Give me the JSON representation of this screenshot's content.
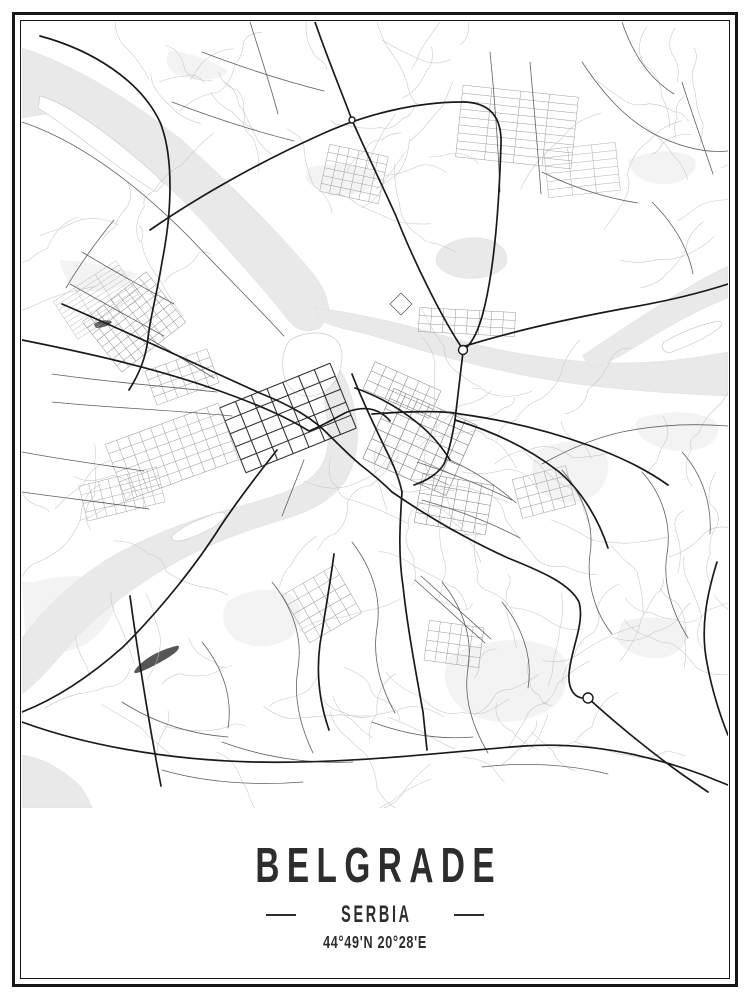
{
  "poster": {
    "title": "BELGRADE",
    "subtitle": "SERBIA",
    "coordinates": "44°49'N 20°28'E",
    "colors": {
      "text": "#2d2d2d",
      "frame": "#161616"
    }
  },
  "map": {
    "colors": {
      "water": "#e9e9e9",
      "water_edge": "#dedede",
      "park": "#f3f3f3",
      "island_edge": "#cccccc",
      "dark_shape": "#565656",
      "minor": "#c6c6c6",
      "medium": "#5f5f5f",
      "major": "#1a1a1a"
    },
    "parks": [
      "M38,238 C70,240 100,246 116,252 C104,266 84,272 60,268 C48,264 40,252 38,238 Z",
      "M205,580 C222,568 248,564 268,572 C280,580 282,596 272,612 C258,626 232,628 214,618 C200,608 198,592 205,580 Z",
      "M516,428 C536,418 562,416 580,428 C590,438 588,456 576,470 C560,484 534,484 520,470 C508,456 508,440 516,428 Z",
      "M428,634 C458,618 500,612 532,626 C548,636 550,660 536,680 C514,702 470,706 444,690 C422,674 418,650 428,634 Z",
      "M618,396 C644,388 672,388 692,398 C700,406 696,420 680,426 C658,432 634,428 620,416 C612,408 612,400 618,396 Z",
      "M286,146 C310,140 336,140 352,150 C358,158 350,168 332,172 C310,174 292,168 284,158 Z",
      "M148,28 C172,32 196,40 206,50 C196,60 172,60 154,52 C144,46 142,36 148,28 Z",
      "M12,560 C40,552 70,552 92,562 C100,580 88,606 64,622 C40,634 16,634 4,624 L0,560 Z",
      "M600,600 C624,592 650,594 664,606 C670,618 660,632 640,636 C618,638 600,628 594,616 Z",
      "M606,138 C628,128 654,126 672,136 C678,146 668,158 648,162 C626,164 608,154 606,138 Z"
    ],
    "water": [
      "M0,26 C50,42 105,75 160,118 C215,168 258,212 288,248 C301,263 307,277 307,292 L298,306 C284,312 274,308 266,298 C248,274 222,246 192,212 C156,172 112,130 66,100 C44,88 20,92 0,96 Z",
      "M292,286 C330,290 375,300 430,316 C490,333 545,340 595,341 C640,341 675,336 706,330 L706,374 C660,372 610,369 555,362 C495,354 440,340 395,327 C365,318 340,310 322,307 L300,300 Z",
      "M296,346 C302,372 306,398 306,422 C304,440 296,452 280,462 C258,474 232,480 205,488 C168,498 132,512 98,530 C62,550 32,576 8,606 L0,616 L0,672 C14,662 30,644 52,618 C80,588 118,560 158,538 C196,518 232,506 266,496 C292,488 312,476 324,458 C334,440 338,420 334,396 C330,372 324,356 318,348 Z",
      "M560,334 C596,310 634,284 672,262 C686,254 697,248 706,244 L706,276 C680,286 650,302 618,322 C596,336 580,344 570,346 Z",
      "M414,238 C414,224 436,214 458,216 C478,218 488,230 484,242 C478,254 452,260 432,254 C420,250 414,244 414,238 Z",
      "M0,733 C22,736 44,750 58,764 C64,772 68,780 70,786 L0,786 Z"
    ],
    "islands": [
      "M18,74 C40,80 70,100 102,126 C122,142 136,154 142,162 L134,170 C120,162 98,146 74,128 C52,111 32,96 16,86 Z",
      "M268,318 C282,310 300,308 312,316 C320,322 322,334 318,348 C314,362 304,372 290,374 C276,375 266,368 262,354 C259,340 261,326 268,318 Z",
      "M150,514 C158,506 174,498 192,492 C200,489 205,490 203,495 C198,503 182,511 166,517 C156,520 148,520 150,514 Z",
      "M642,320 C656,312 674,304 692,300 C700,298 702,302 696,307 C684,316 666,324 650,330 C642,332 638,326 642,320 Z"
    ],
    "dark_shapes": [
      "M113,648 C122,636 138,628 154,624 C158,623 158,626 154,630 C144,638 128,646 118,650 C113,652 111,651 113,648 Z",
      "M72,302 C78,298 86,297 90,300 C87,304 80,306 74,306 Z"
    ],
    "grids": [
      {
        "cx": 266,
        "cy": 396,
        "rows": 5,
        "cols": 7,
        "cw": 17,
        "ch": 14,
        "angle": -22,
        "stroke": "#2e2e2e",
        "width": 1.05
      },
      {
        "cx": 150,
        "cy": 430,
        "rows": 6,
        "cols": 10,
        "cw": 12,
        "ch": 10,
        "angle": -20,
        "stroke": "#9a9a9a",
        "width": 0.5
      },
      {
        "cx": 100,
        "cy": 472,
        "rows": 4,
        "cols": 8,
        "cw": 10,
        "ch": 9,
        "angle": -14,
        "stroke": "#a8a8a8",
        "width": 0.5
      },
      {
        "cx": 112,
        "cy": 300,
        "rows": 8,
        "cols": 9,
        "cw": 9,
        "ch": 8,
        "angle": -38,
        "stroke": "#8d8d8d",
        "width": 0.5
      },
      {
        "cx": 75,
        "cy": 278,
        "rows": 9,
        "cols": 3,
        "cw": 25,
        "ch": 5,
        "angle": -33,
        "stroke": "#b3b3b3",
        "width": 0.45
      },
      {
        "cx": 495,
        "cy": 105,
        "rows": 9,
        "cols": 4,
        "cw": 29,
        "ch": 8,
        "angle": 6,
        "stroke": "#9c9c9c",
        "width": 0.5
      },
      {
        "cx": 560,
        "cy": 148,
        "rows": 6,
        "cols": 3,
        "cw": 24,
        "ch": 8,
        "angle": -6,
        "stroke": "#a8a8a8",
        "width": 0.45
      },
      {
        "cx": 332,
        "cy": 152,
        "rows": 6,
        "cols": 6,
        "cw": 10,
        "ch": 8,
        "angle": 12,
        "stroke": "#9c9c9c",
        "width": 0.5
      },
      {
        "cx": 398,
        "cy": 420,
        "rows": 7,
        "cols": 7,
        "cw": 13,
        "ch": 11,
        "angle": 24,
        "stroke": "#6f6f6f",
        "width": 0.55
      },
      {
        "cx": 380,
        "cy": 368,
        "rows": 3,
        "cols": 6,
        "cw": 12,
        "ch": 10,
        "angle": 24,
        "stroke": "#7d7d7d",
        "width": 0.5
      },
      {
        "cx": 432,
        "cy": 482,
        "rows": 5,
        "cols": 6,
        "cw": 12,
        "ch": 10,
        "angle": 10,
        "stroke": "#7d7d7d",
        "width": 0.5
      },
      {
        "cx": 300,
        "cy": 582,
        "rows": 5,
        "cols": 5,
        "cw": 12,
        "ch": 11,
        "angle": -30,
        "stroke": "#9a9a9a",
        "width": 0.5
      },
      {
        "cx": 522,
        "cy": 470,
        "rows": 4,
        "cols": 5,
        "cw": 11,
        "ch": 10,
        "angle": -15,
        "stroke": "#9a9a9a",
        "width": 0.5
      },
      {
        "cx": 432,
        "cy": 622,
        "rows": 4,
        "cols": 5,
        "cw": 11,
        "ch": 10,
        "angle": 8,
        "stroke": "#9a9a9a",
        "width": 0.5
      },
      {
        "cx": 160,
        "cy": 355,
        "rows": 4,
        "cols": 6,
        "cw": 11,
        "ch": 9,
        "angle": -20,
        "stroke": "#9a9a9a",
        "width": 0.5
      },
      {
        "cx": 445,
        "cy": 300,
        "rows": 3,
        "cols": 8,
        "cw": 12,
        "ch": 8,
        "angle": 3,
        "stroke": "#8d8d8d",
        "width": 0.45
      }
    ],
    "scribbles": [
      {
        "x": 120,
        "y": 20,
        "w": 140,
        "h": 90,
        "count": 9,
        "seed": 7
      },
      {
        "x": 250,
        "y": 15,
        "w": 190,
        "h": 85,
        "count": 9,
        "seed": 11
      },
      {
        "x": 565,
        "y": 20,
        "w": 135,
        "h": 200,
        "count": 13,
        "seed": 23
      },
      {
        "x": 585,
        "y": 385,
        "w": 118,
        "h": 290,
        "count": 15,
        "seed": 31
      },
      {
        "x": 245,
        "y": 525,
        "w": 320,
        "h": 210,
        "count": 24,
        "seed": 43
      },
      {
        "x": 60,
        "y": 640,
        "w": 160,
        "h": 108,
        "count": 10,
        "seed": 53
      },
      {
        "x": 350,
        "y": 395,
        "w": 180,
        "h": 110,
        "count": 13,
        "seed": 61
      },
      {
        "x": 445,
        "y": 362,
        "w": 125,
        "h": 85,
        "count": 9,
        "seed": 71
      },
      {
        "x": 45,
        "y": 195,
        "w": 100,
        "h": 90,
        "count": 7,
        "seed": 83
      },
      {
        "x": 300,
        "y": 120,
        "w": 130,
        "h": 90,
        "count": 8,
        "seed": 97
      },
      {
        "x": 380,
        "y": 680,
        "w": 300,
        "h": 95,
        "count": 10,
        "seed": 101
      },
      {
        "x": 25,
        "y": 420,
        "w": 90,
        "h": 110,
        "count": 7,
        "seed": 113
      }
    ],
    "roads_medium": [
      "M126,316 C150,330 172,344 192,356",
      "M30,352 C85,360 140,364 195,370",
      "M30,380 C90,386 150,388 210,394",
      "M60,230 C90,248 122,266 152,282",
      "M48,262 C80,280 112,298 142,314",
      "M92,198 C74,220 58,242 44,266",
      "M395,440 C425,450 458,462 490,478",
      "M400,478 C432,487 466,499 498,516",
      "M428,438 C452,449 474,463 494,481",
      "M520,442 C545,428 572,416 600,410 C634,403 668,401 706,404",
      "M540,448 C560,472 573,502 568,532 C564,562 574,592 590,612",
      "M620,450 C640,472 650,502 645,532 C640,562 651,592 666,616",
      "M660,430 C680,452 690,482 688,512",
      "M560,40 C580,70 602,96 632,112 C662,127 686,131 706,129",
      "M600,0 C610,30 626,56 652,72",
      "M660,60 C670,92 681,122 691,152",
      "M520,150 C552,166 584,176 616,181",
      "M630,180 C652,202 666,226 671,252",
      "M180,30 C222,46 262,59 302,69",
      "M228,0 C238,32 248,62 256,92",
      "M150,80 C192,96 232,109 272,119",
      "M330,520 C350,546 360,576 355,606 C350,636 359,666 373,691",
      "M420,560 C441,586 451,616 446,646 C441,676 451,706 466,731",
      "M480,580 C501,606 511,636 506,666",
      "M250,560 C271,586 281,616 276,646 C271,676 279,706 291,731",
      "M180,620 C201,646 211,676 206,706",
      "M350,700 C382,712 416,718 451,715",
      "M200,720 C241,735 286,742 331,740",
      "M100,680 C131,700 166,712 206,715",
      "M140,748 C181,760 231,764 281,760",
      "M460,745 C501,740 546,742 586,752",
      "M0,430 C42,438 82,443 122,449",
      "M0,470 C42,476 87,481 127,487",
      "M393,558 L463,621",
      "M399,554 L469,617",
      "M0,100 C60,120 116,164 166,214 C206,256 240,290 262,314",
      "M368,282 L379,271 L390,282 L379,293 Z",
      "M282,438 L260,494",
      "M468,30 C472,70 476,120 478,170",
      "M508,40 C512,85 516,130 519,172"
    ],
    "roads_major": [
      "M18,14 C70,28 118,58 138,100 C152,135 150,190 140,240 C135,272 128,296 126,316 C124,336 117,352 107,368",
      "M0,318 C60,330 130,345 195,368 C240,384 266,396 287,409 C300,404 313,396 325,390 C344,383 358,387 368,399",
      "M40,282 C110,312 180,345 240,372 C270,384 292,397 308,414 C320,426 330,436 340,444 C354,455 362,462 370,470",
      "M370,470 C402,492 442,516 486,536 C521,550 548,562 557,580 C563,602 549,626 547,652 C546,668 553,678 566,676 C590,698 626,728 661,753 L686,770",
      "M380,470 C378,500 376,532 381,564 C385,602 393,646 401,690 L405,728",
      "M350,392 C392,389 424,389 438,392 C482,398 527,409 566,423 C596,434 622,446 646,463",
      "M333,366 C356,374 379,387 398,403 C410,413 420,425 428,438",
      "M330,352 C340,378 352,403 364,428 C372,444 377,456 380,470",
      "M128,208 C180,172 242,138 300,112 C342,93 392,80 440,80 C466,80 480,93 479,122 C477,182 473,242 462,287 C457,308 451,320 443,327",
      "M293,0 C305,35 318,66 330,98 C345,132 360,163 374,194 C392,240 420,296 440,326",
      "M441,330 L433,398 C430,416 427,430 422,442 C416,452 404,459 392,463",
      "M433,398 C470,409 506,426 536,449 C559,468 576,496 586,526",
      "M443,324 C495,308 550,296 605,286 C640,280 675,272 706,262",
      "M255,428 C236,452 216,478 198,505 C176,540 141,585 101,625 C66,656 31,678 0,690",
      "M0,700 C60,722 142,738 232,740 C332,742 422,730 502,724 C562,720 622,731 681,753 L706,763",
      "M312,532 C308,562 303,592 298,622 C294,652 298,682 307,708",
      "M695,540 C685,572 678,606 685,641 C690,669 699,696 706,713",
      "M108,574 C117,640 127,702 139,764"
    ],
    "circles": [
      {
        "cx": 441,
        "cy": 328,
        "r": 4.5
      },
      {
        "cx": 330,
        "cy": 98,
        "r": 3
      },
      {
        "cx": 566,
        "cy": 676,
        "r": 5
      }
    ]
  }
}
